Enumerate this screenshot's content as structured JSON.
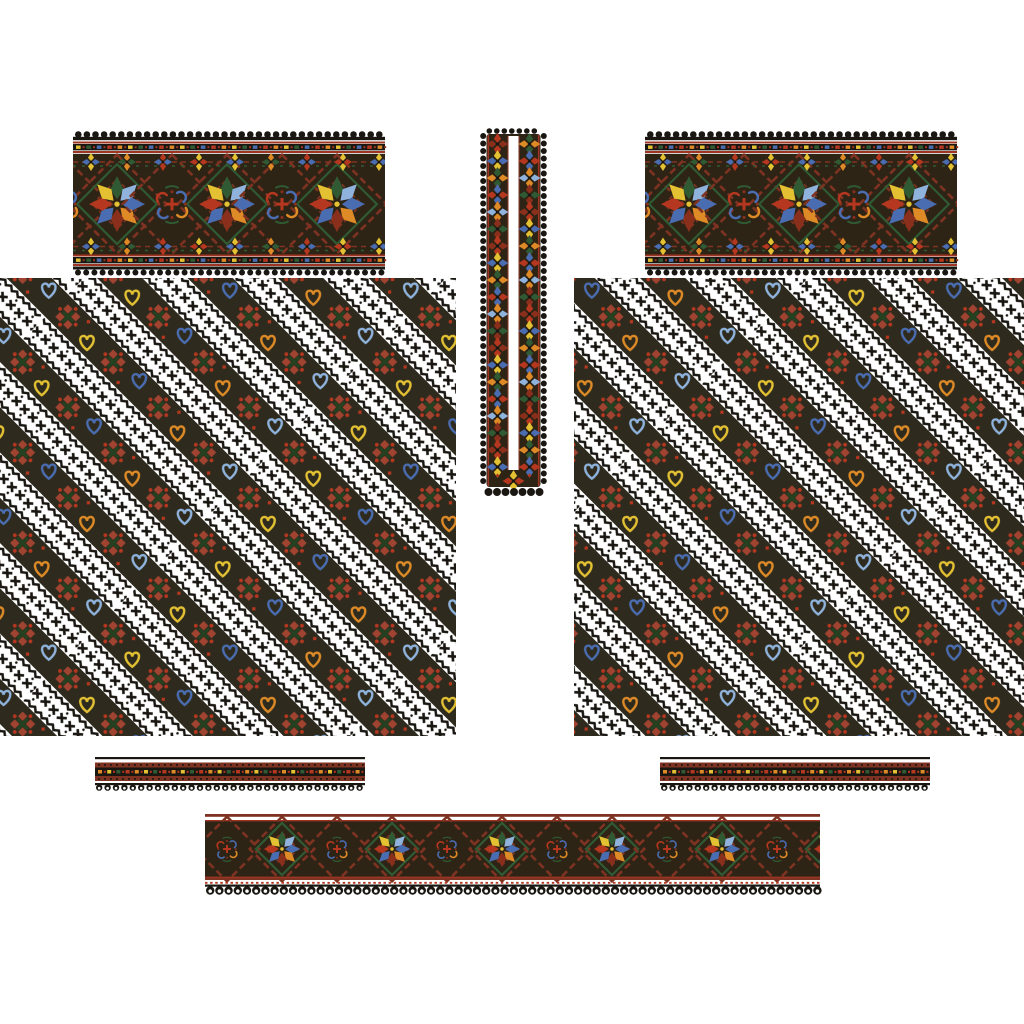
{
  "document": {
    "kind": "cross-stitch embroidery pattern sheet",
    "style": "Ukrainian vyshyvanka shirt layout",
    "background": "#ffffff"
  },
  "palette": {
    "black": "#1a1712",
    "band_bg": "#2d2416",
    "stripe_bg": "#2e2b1e",
    "maroon": "#7e3322",
    "dark_red": "#8a2f1c",
    "red": "#b5371f",
    "rose_red": "#a04330",
    "border_red": "#9e3522",
    "orange": "#de8a26",
    "yellow": "#e4c133",
    "green": "#2f5a33",
    "dark_green": "#24421f",
    "blue": "#4a6cb0",
    "light_blue": "#8fb3dc",
    "white": "#ffffff"
  },
  "motifs": {
    "star_petals": [
      "green",
      "light_blue",
      "blue",
      "orange",
      "dark_red",
      "blue",
      "red",
      "yellow"
    ],
    "scroll_curls": [
      "red",
      "blue",
      "blue",
      "orange"
    ],
    "heart_cycle": [
      "yellow",
      "blue",
      "orange",
      "light_blue"
    ],
    "border_dashes": [
      "yellow",
      "green",
      "blue",
      "red",
      "orange"
    ],
    "cuff_dashes": [
      "orange",
      "yellow",
      "green",
      "red"
    ],
    "tulip_pairs": [
      [
        "yellow",
        "blue"
      ],
      [
        "orange",
        "green"
      ],
      [
        "red",
        "blue"
      ],
      [
        "yellow",
        "red"
      ]
    ],
    "pinwheel_pairs": [
      [
        "red",
        "dark_red"
      ],
      [
        "yellow",
        "blue"
      ],
      [
        "green",
        "orange"
      ],
      [
        "blue",
        "red"
      ],
      [
        "orange",
        "light_blue"
      ],
      [
        "dark_red",
        "green"
      ]
    ]
  },
  "layout_data": {
    "band_tile": 110,
    "stripe_period": 64,
    "stripe_motif_step": 32
  },
  "panels": {
    "left-yoke-band": {
      "x": 73,
      "y": 131,
      "w": 312,
      "h": 146,
      "type": "yoke",
      "motif": "diamond stars with scroll medallions"
    },
    "right-yoke-band": {
      "x": 645,
      "y": 131,
      "w": 312,
      "h": 146,
      "type": "yoke",
      "motif": "diamond stars with scroll medallions"
    },
    "left-sleeve-panel": {
      "x": 0,
      "y": 278,
      "w": 456,
      "h": 458,
      "type": "stripes",
      "motif": "diagonal rose and heart stripes with barbed chains"
    },
    "right-sleeve-panel": {
      "x": 574,
      "y": 278,
      "w": 450,
      "h": 458,
      "type": "stripes",
      "motif": "diagonal rose and heart stripes with barbed chains"
    },
    "neck-placket-strip": {
      "x": 480,
      "y": 128,
      "w": 67,
      "h": 369,
      "type": "placket",
      "motif": "twin pinwheel columns around slit"
    },
    "left-cuff-band": {
      "x": 95,
      "y": 757,
      "w": 270,
      "h": 34,
      "type": "cuff",
      "motif": "dash row with picot edge"
    },
    "right-cuff-band": {
      "x": 660,
      "y": 757,
      "w": 270,
      "h": 34,
      "type": "cuff",
      "motif": "dash row with picot edge"
    },
    "bottom-hem-band": {
      "x": 205,
      "y": 814,
      "w": 615,
      "h": 80,
      "type": "hem",
      "motif": "diamond stars with scroll medallions"
    }
  }
}
